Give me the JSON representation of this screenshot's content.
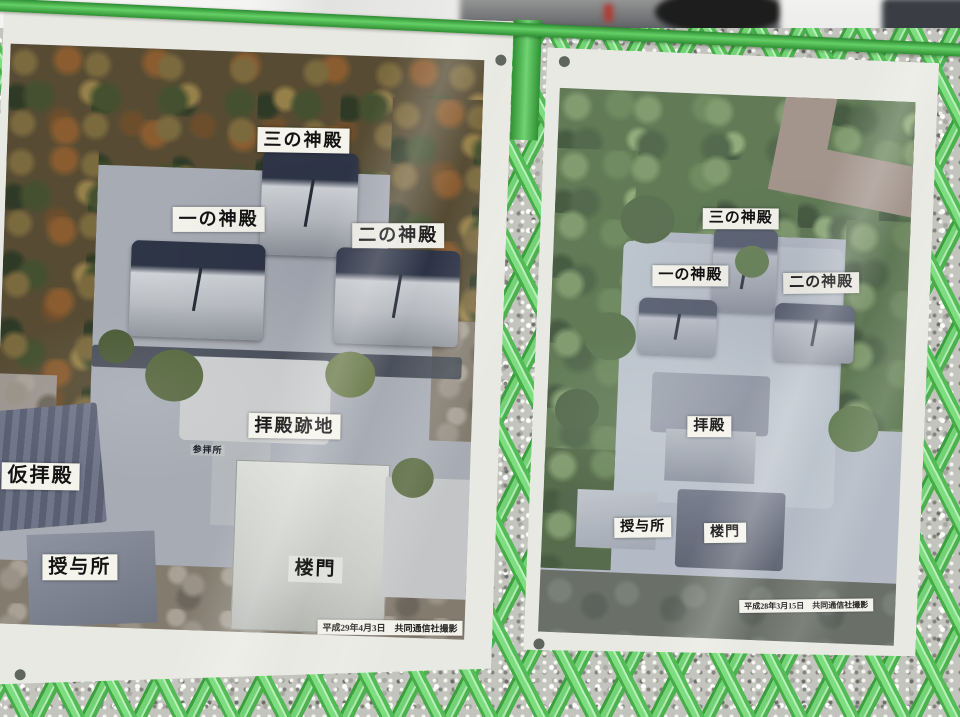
{
  "colors": {
    "fence_green": "#4fbf52",
    "fence_green_light": "#8fe391",
    "panel_white": "#e9e9e3",
    "label_background": "#f5f4ec",
    "label_text": "#131313"
  },
  "left_panel": {
    "labels": {
      "san_no_shinden": "三の神殿",
      "ichi_no_shinden": "一の神殿",
      "ni_no_shinden": "二の神殿",
      "haiden_atochi": "拝殿跡地",
      "sanpaisho": "参拝所",
      "karihaiden": "仮拝殿",
      "juyosho": "授与所",
      "romon": "楼門"
    },
    "caption": "平成29年4月3日　共同通信社撮影"
  },
  "right_panel": {
    "labels": {
      "san_no_shinden": "三の神殿",
      "ichi_no_shinden": "一の神殿",
      "ni_no_shinden": "二の神殿",
      "haiden": "拝殿",
      "juyosho": "授与所",
      "romon": "楼門"
    },
    "caption": "平成28年3月15日　共同通信社撮影"
  }
}
